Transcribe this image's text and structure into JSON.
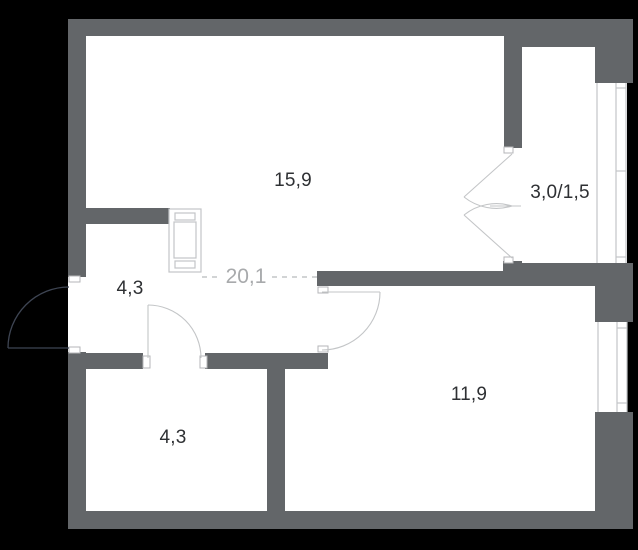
{
  "plan": {
    "type": "apartment-floor-plan",
    "rooms": [
      {
        "name": "living-room",
        "area": "15,9"
      },
      {
        "name": "balcony",
        "area": "3,0/1,5"
      },
      {
        "name": "hallway",
        "area": "4,3"
      },
      {
        "name": "combined-zone",
        "area": "20,1"
      },
      {
        "name": "bedroom",
        "area": "11,9"
      },
      {
        "name": "bathroom",
        "area": "4,3"
      }
    ],
    "colors": {
      "background": "#000000",
      "floor": "#ffffff",
      "wall": "#636669",
      "line": "#c3c5c7",
      "jamb_stroke": "#b4b6b8",
      "label": "#2e3033",
      "zone_label": "#a8aaac",
      "entry_door": "#3e4553"
    }
  }
}
